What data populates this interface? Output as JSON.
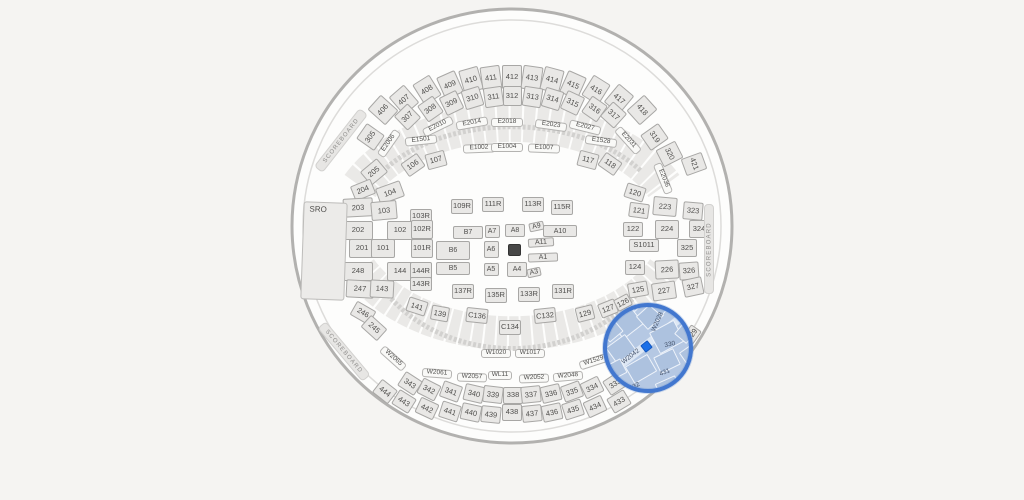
{
  "map": {
    "colors": {
      "bg": "#f5f4f2",
      "section_fill": "#e9e8e6",
      "section_border": "#a8a7a5",
      "label": "#4f4e4c",
      "stage": "#474747",
      "ring": "#4277cf",
      "hl_fill": "#b5c8e3",
      "hl_sec": "#adc2df",
      "hl_border": "#eef3fa",
      "seat": "#1a6fe8",
      "scoreboard_text": "#8f8e8c"
    },
    "highlight": {
      "cx": 648,
      "cy": 348,
      "r": 45,
      "selected_sections": [
        "W2028",
        "W2042",
        "330",
        "431",
        "432"
      ]
    },
    "scoreboard_label": "SCOREBOARD",
    "sro_label": "SRO",
    "sections": [
      [
        "406",
        383,
        110,
        20,
        24,
        -48,
        "sec"
      ],
      [
        "407",
        404,
        100,
        20,
        24,
        -41,
        "sec"
      ],
      [
        "408",
        427,
        90,
        20,
        24,
        -32,
        "sec"
      ],
      [
        "409",
        450,
        85,
        20,
        24,
        -24,
        "sec"
      ],
      [
        "410",
        471,
        80,
        20,
        24,
        -16,
        "sec"
      ],
      [
        "411",
        491,
        78,
        20,
        24,
        -8,
        "sec"
      ],
      [
        "412",
        512,
        77,
        20,
        24,
        0,
        "sec"
      ],
      [
        "413",
        532,
        78,
        20,
        24,
        8,
        "sec"
      ],
      [
        "414",
        552,
        80,
        20,
        24,
        15,
        "sec"
      ],
      [
        "415",
        573,
        85,
        20,
        24,
        24,
        "sec"
      ],
      [
        "416",
        596,
        90,
        20,
        24,
        32,
        "sec"
      ],
      [
        "417",
        619,
        99,
        20,
        24,
        40,
        "sec"
      ],
      [
        "418",
        642,
        110,
        20,
        24,
        48,
        "sec"
      ],
      [
        "305",
        370,
        137,
        19,
        22,
        -55,
        "sec"
      ],
      [
        "307",
        407,
        117,
        19,
        20,
        -44,
        "sec"
      ],
      [
        "308",
        430,
        109,
        19,
        20,
        -35,
        "sec"
      ],
      [
        "309",
        451,
        103,
        19,
        20,
        -26,
        "sec"
      ],
      [
        "310",
        472,
        98,
        19,
        20,
        -17,
        "sec"
      ],
      [
        "311",
        493,
        97,
        19,
        20,
        -8,
        "sec"
      ],
      [
        "312",
        512,
        96,
        19,
        20,
        0,
        "sec"
      ],
      [
        "313",
        532,
        97,
        19,
        20,
        9,
        "sec"
      ],
      [
        "314",
        552,
        99,
        19,
        20,
        17,
        "sec"
      ],
      [
        "315",
        572,
        103,
        19,
        20,
        25,
        "sec"
      ],
      [
        "316",
        594,
        109,
        19,
        20,
        35,
        "sec"
      ],
      [
        "317",
        613,
        115,
        19,
        20,
        42,
        "sec"
      ],
      [
        "319",
        654,
        137,
        19,
        22,
        55,
        "sec"
      ],
      [
        "320",
        669,
        154,
        19,
        22,
        63,
        "sec"
      ],
      [
        "421",
        694,
        164,
        18,
        22,
        70,
        "sec"
      ],
      [
        "E2006",
        389,
        143,
        30,
        9,
        -55,
        "pill"
      ],
      [
        "E2010",
        438,
        126,
        32,
        9,
        -26,
        "pill"
      ],
      [
        "E2014",
        472,
        123,
        32,
        9,
        -10,
        "pill"
      ],
      [
        "E2018",
        507,
        122,
        32,
        9,
        0,
        "pill"
      ],
      [
        "E2023",
        551,
        125,
        32,
        9,
        8,
        "pill"
      ],
      [
        "E2027",
        585,
        127,
        32,
        9,
        14,
        "pill"
      ],
      [
        "E2031",
        628,
        140,
        32,
        9,
        48,
        "pill"
      ],
      [
        "E2036",
        663,
        178,
        32,
        9,
        68,
        "pill"
      ],
      [
        "E1501",
        421,
        140,
        32,
        9,
        -6,
        "pill"
      ],
      [
        "E1528",
        601,
        141,
        32,
        9,
        8,
        "pill"
      ],
      [
        "E1002",
        479,
        148,
        32,
        9,
        -2,
        "pill"
      ],
      [
        "E1004",
        507,
        147,
        32,
        9,
        0,
        "pill"
      ],
      [
        "E1007",
        544,
        148,
        32,
        9,
        2,
        "pill"
      ],
      [
        "106",
        413,
        165,
        20,
        16,
        -35,
        "sec"
      ],
      [
        "107",
        436,
        160,
        20,
        16,
        -15,
        "sec"
      ],
      [
        "117",
        588,
        160,
        20,
        16,
        15,
        "sec"
      ],
      [
        "118",
        610,
        164,
        20,
        16,
        35,
        "sec"
      ],
      [
        "205",
        374,
        172,
        22,
        18,
        -40,
        "sec"
      ],
      [
        "204",
        363,
        190,
        22,
        16,
        -22,
        "sec"
      ],
      [
        "104",
        390,
        192,
        26,
        17,
        -20,
        "sec"
      ],
      [
        "203",
        358,
        207,
        30,
        19,
        -3,
        "sec"
      ],
      [
        "103",
        384,
        210,
        26,
        19,
        -5,
        "sec"
      ],
      [
        "103R",
        421,
        216,
        22,
        15,
        0,
        "sec"
      ],
      [
        "202",
        358,
        230,
        30,
        19,
        0,
        "sec"
      ],
      [
        "102",
        400,
        230,
        26,
        19,
        0,
        "sec"
      ],
      [
        "102R",
        422,
        229,
        22,
        19,
        0,
        "sec"
      ],
      [
        "201",
        362,
        248,
        26,
        19,
        0,
        "sec"
      ],
      [
        "101",
        383,
        248,
        24,
        19,
        0,
        "sec"
      ],
      [
        "101R",
        422,
        248,
        22,
        19,
        0,
        "sec"
      ],
      [
        "248",
        358,
        271,
        30,
        19,
        0,
        "sec"
      ],
      [
        "144",
        400,
        271,
        26,
        19,
        0,
        "sec"
      ],
      [
        "144R",
        421,
        271,
        22,
        19,
        0,
        "sec"
      ],
      [
        "247",
        360,
        289,
        28,
        18,
        3,
        "sec"
      ],
      [
        "143",
        382,
        289,
        24,
        18,
        3,
        "sec"
      ],
      [
        "143R",
        421,
        284,
        22,
        14,
        0,
        "sec"
      ],
      [
        "141",
        417,
        306,
        20,
        15,
        18,
        "sec"
      ],
      [
        "139",
        440,
        313,
        18,
        15,
        10,
        "sec"
      ],
      [
        "246",
        363,
        313,
        22,
        16,
        30,
        "sec"
      ],
      [
        "245",
        374,
        328,
        22,
        16,
        42,
        "sec"
      ],
      [
        "109R",
        462,
        206,
        22,
        15,
        0,
        "sec"
      ],
      [
        "111R",
        493,
        204,
        22,
        15,
        0,
        "sec"
      ],
      [
        "113R",
        533,
        204,
        22,
        15,
        0,
        "sec"
      ],
      [
        "115R",
        562,
        207,
        22,
        15,
        0,
        "sec"
      ],
      [
        "137R",
        463,
        291,
        22,
        15,
        0,
        "sec"
      ],
      [
        "135R",
        496,
        295,
        22,
        15,
        0,
        "sec"
      ],
      [
        "133R",
        529,
        294,
        22,
        15,
        0,
        "sec"
      ],
      [
        "131R",
        563,
        291,
        22,
        15,
        0,
        "sec"
      ],
      [
        "B7",
        468,
        232,
        30,
        13,
        0,
        "fld"
      ],
      [
        "A7",
        492,
        231,
        15,
        13,
        0,
        "fld"
      ],
      [
        "A8",
        515,
        230,
        20,
        13,
        0,
        "fld"
      ],
      [
        "A9",
        536,
        226,
        15,
        9,
        -12,
        "fld"
      ],
      [
        "A10",
        560,
        231,
        34,
        12,
        0,
        "fld"
      ],
      [
        "B6",
        453,
        250,
        34,
        19,
        0,
        "fld"
      ],
      [
        "A6",
        491,
        249,
        15,
        17,
        0,
        "fld"
      ],
      [
        "A11",
        541,
        242,
        26,
        9,
        -4,
        "fld"
      ],
      [
        "A1",
        543,
        257,
        30,
        9,
        -2,
        "fld"
      ],
      [
        "B5",
        453,
        268,
        34,
        13,
        0,
        "fld"
      ],
      [
        "A5",
        491,
        269,
        15,
        13,
        0,
        "fld"
      ],
      [
        "A4",
        517,
        269,
        20,
        15,
        0,
        "fld"
      ],
      [
        "A3",
        534,
        272,
        14,
        9,
        -12,
        "fld"
      ],
      [
        "",
        514,
        250,
        13,
        12,
        0,
        "stage"
      ],
      [
        "C136",
        477,
        315,
        22,
        15,
        6,
        "sec"
      ],
      [
        "C134",
        510,
        327,
        22,
        15,
        0,
        "sec"
      ],
      [
        "C132",
        545,
        315,
        22,
        15,
        -6,
        "sec"
      ],
      [
        "129",
        585,
        313,
        18,
        15,
        -14,
        "sec"
      ],
      [
        "127",
        608,
        308,
        18,
        15,
        -22,
        "sec"
      ],
      [
        "126",
        623,
        302,
        16,
        13,
        -28,
        "sec"
      ],
      [
        "120",
        635,
        192,
        20,
        15,
        18,
        "sec"
      ],
      [
        "121",
        639,
        210,
        20,
        15,
        8,
        "sec"
      ],
      [
        "223",
        665,
        206,
        24,
        19,
        5,
        "sec"
      ],
      [
        "323",
        693,
        211,
        20,
        18,
        5,
        "sec"
      ],
      [
        "122",
        633,
        229,
        20,
        15,
        0,
        "sec"
      ],
      [
        "224",
        667,
        229,
        24,
        19,
        0,
        "sec"
      ],
      [
        "324",
        699,
        229,
        20,
        18,
        0,
        "sec"
      ],
      [
        "S1011",
        644,
        245,
        30,
        13,
        0,
        "sec"
      ],
      [
        "325",
        687,
        248,
        20,
        18,
        0,
        "sec"
      ],
      [
        "124",
        635,
        267,
        20,
        15,
        0,
        "sec"
      ],
      [
        "226",
        667,
        269,
        24,
        19,
        -3,
        "sec"
      ],
      [
        "326",
        689,
        271,
        20,
        18,
        -4,
        "sec"
      ],
      [
        "125",
        638,
        289,
        20,
        15,
        -10,
        "sec"
      ],
      [
        "227",
        664,
        291,
        24,
        18,
        -8,
        "sec"
      ],
      [
        "327",
        693,
        287,
        20,
        18,
        -12,
        "sec"
      ],
      [
        "429",
        692,
        334,
        16,
        13,
        -55,
        "sec"
      ],
      [
        "343",
        410,
        383,
        20,
        17,
        33,
        "sec"
      ],
      [
        "342",
        429,
        389,
        20,
        17,
        27,
        "sec"
      ],
      [
        "341",
        451,
        391,
        20,
        17,
        20,
        "sec"
      ],
      [
        "340",
        474,
        393,
        20,
        17,
        13,
        "sec"
      ],
      [
        "339",
        493,
        394,
        20,
        17,
        7,
        "sec"
      ],
      [
        "338",
        513,
        395,
        20,
        17,
        0,
        "sec"
      ],
      [
        "337",
        531,
        394,
        20,
        17,
        -6,
        "sec"
      ],
      [
        "336",
        551,
        393,
        20,
        17,
        -13,
        "sec"
      ],
      [
        "335",
        572,
        391,
        20,
        17,
        -20,
        "sec"
      ],
      [
        "334",
        592,
        387,
        20,
        17,
        -26,
        "sec"
      ],
      [
        "333",
        615,
        383,
        20,
        17,
        -33,
        "sec"
      ],
      [
        "444",
        385,
        391,
        20,
        17,
        38,
        "sec"
      ],
      [
        "443",
        404,
        401,
        20,
        17,
        32,
        "sec"
      ],
      [
        "442",
        427,
        408,
        20,
        17,
        25,
        "sec"
      ],
      [
        "441",
        450,
        411,
        20,
        17,
        18,
        "sec"
      ],
      [
        "440",
        471,
        412,
        20,
        17,
        12,
        "sec"
      ],
      [
        "439",
        491,
        414,
        20,
        17,
        6,
        "sec"
      ],
      [
        "438",
        512,
        412,
        20,
        17,
        0,
        "sec"
      ],
      [
        "437",
        532,
        413,
        20,
        17,
        -6,
        "sec"
      ],
      [
        "436",
        552,
        412,
        20,
        17,
        -12,
        "sec"
      ],
      [
        "435",
        573,
        409,
        20,
        17,
        -18,
        "sec"
      ],
      [
        "434",
        595,
        406,
        20,
        17,
        -25,
        "sec"
      ],
      [
        "433",
        619,
        401,
        20,
        17,
        -31,
        "sec"
      ],
      [
        "W1020",
        496,
        353,
        30,
        9,
        0,
        "pill"
      ],
      [
        "W1017",
        530,
        353,
        30,
        9,
        0,
        "pill"
      ],
      [
        "W1529",
        594,
        361,
        30,
        9,
        -18,
        "pill"
      ],
      [
        "W2061",
        437,
        373,
        30,
        9,
        4,
        "pill"
      ],
      [
        "W2057",
        472,
        377,
        30,
        9,
        2,
        "pill"
      ],
      [
        "WL11",
        500,
        375,
        24,
        9,
        0,
        "pill"
      ],
      [
        "W2052",
        534,
        378,
        30,
        9,
        -2,
        "pill"
      ],
      [
        "W2048",
        568,
        376,
        30,
        9,
        -5,
        "pill"
      ],
      [
        "W2065",
        393,
        358,
        30,
        9,
        42,
        "pill"
      ],
      [
        "SRO",
        324,
        251,
        44,
        98,
        2,
        "sro"
      ],
      [
        "",
        341,
        140,
        74,
        11,
        -52,
        "sbar"
      ],
      [
        "SCOREBOARD",
        341,
        140,
        74,
        11,
        -52,
        "stext"
      ],
      [
        "",
        344,
        351,
        70,
        11,
        50,
        "sbar"
      ],
      [
        "SCOREBOARD",
        344,
        351,
        70,
        11,
        50,
        "stext"
      ],
      [
        "",
        709,
        249,
        10,
        90,
        0,
        "sbar"
      ],
      [
        "SCOREBOARD",
        709,
        249,
        90,
        11,
        -90,
        "stext"
      ],
      [
        "",
        646,
        345,
        96,
        8,
        -38,
        "hlband"
      ],
      [
        "",
        627,
        323,
        26,
        22,
        -38,
        "hl"
      ],
      [
        "",
        650,
        316,
        22,
        18,
        -42,
        "hl"
      ],
      [
        "",
        621,
        349,
        24,
        20,
        -36,
        "hl"
      ],
      [
        "",
        667,
        337,
        28,
        24,
        -28,
        "hl"
      ],
      [
        "",
        641,
        369,
        26,
        20,
        -30,
        "hl"
      ],
      [
        "",
        667,
        361,
        22,
        18,
        -26,
        "hl"
      ],
      [
        "",
        686,
        332,
        18,
        16,
        -50,
        "hl"
      ],
      [
        "",
        615,
        370,
        20,
        16,
        -28,
        "hl"
      ],
      [
        "",
        668,
        387,
        22,
        16,
        -24,
        "hl"
      ],
      [
        "",
        611,
        330,
        18,
        18,
        -40,
        "hl"
      ],
      [
        "",
        637,
        300,
        20,
        14,
        -45,
        "hl"
      ],
      [
        "",
        662,
        305,
        18,
        14,
        -50,
        "hl"
      ],
      [
        "",
        690,
        355,
        16,
        16,
        -35,
        "hl"
      ],
      [
        "W2028",
        658,
        322,
        30,
        8,
        -66,
        "hlab"
      ],
      [
        "W2042",
        631,
        357,
        30,
        8,
        -38,
        "hlab"
      ],
      [
        "330",
        670,
        345,
        18,
        10,
        -12,
        "hlab"
      ],
      [
        "431",
        665,
        373,
        18,
        10,
        -22,
        "hlab"
      ],
      [
        "432",
        635,
        387,
        18,
        10,
        -28,
        "hlab"
      ],
      [
        "",
        646,
        346,
        9,
        9,
        -38,
        "seat"
      ]
    ]
  }
}
